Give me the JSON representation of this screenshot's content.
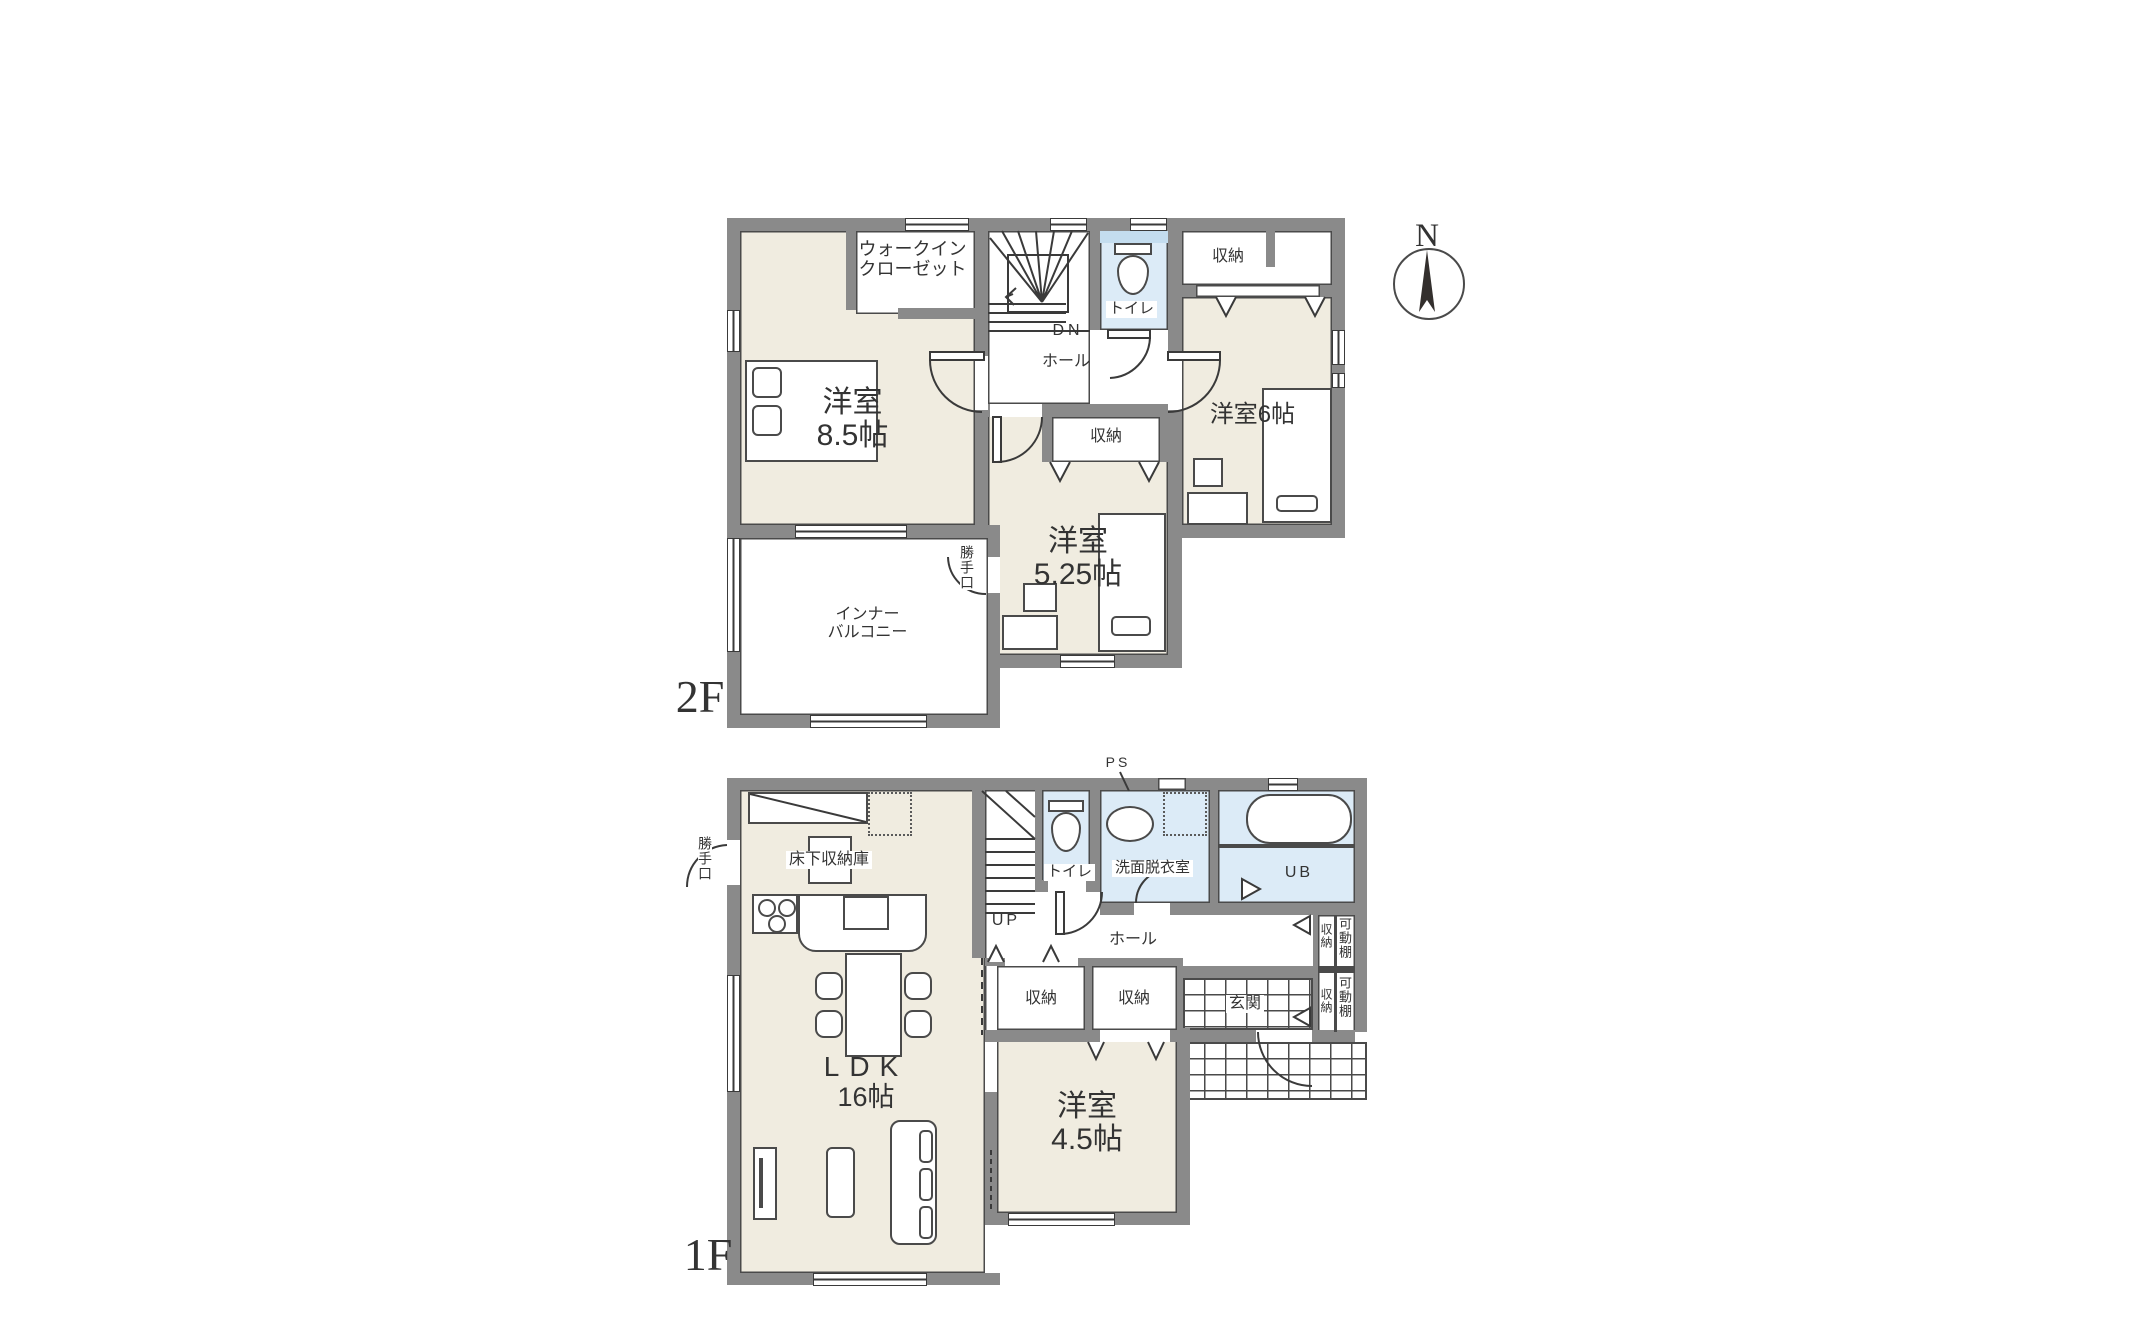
{
  "colors": {
    "wall": "#8a8a8a",
    "floor": "#f0ece0",
    "wet": "#dcebf7",
    "line": "#3a3a3a"
  },
  "compass": {
    "north": "N"
  },
  "floor2": {
    "name": "2F",
    "labels": {
      "wic_line1": "ウォークイン",
      "wic_line2": "クローゼット",
      "bedroom85_name": "洋室",
      "bedroom85_size": "8.5帖",
      "dn": "DN",
      "hall": "ホール",
      "toilet": "トイレ",
      "closet_top": "収納",
      "bedroom6": "洋室6帖",
      "closet_mid": "収納",
      "bedroom525_name": "洋室",
      "bedroom525_size": "5.25帖",
      "service_door": "勝手口",
      "balcony_line1": "インナー",
      "balcony_line2": "バルコニー"
    }
  },
  "floor1": {
    "name": "1F",
    "labels": {
      "service_door": "勝手口",
      "floor_storage": "床下収納庫",
      "up": "UP",
      "toilet": "トイレ",
      "washroom": "洗面脱衣室",
      "ps": "PS",
      "ub": "UB",
      "hall": "ホール",
      "shelf_top": "可動棚",
      "shoe_storage_top": "収納",
      "shelf_bottom": "可動棚",
      "shoe_storage_bottom": "収納",
      "entrance": "玄関",
      "closet_hall": "収納",
      "closet_bedroom": "収納",
      "bedroom45_name": "洋室",
      "bedroom45_size": "4.5帖",
      "ldk_name": "LDK",
      "ldk_size": "16帖"
    }
  }
}
